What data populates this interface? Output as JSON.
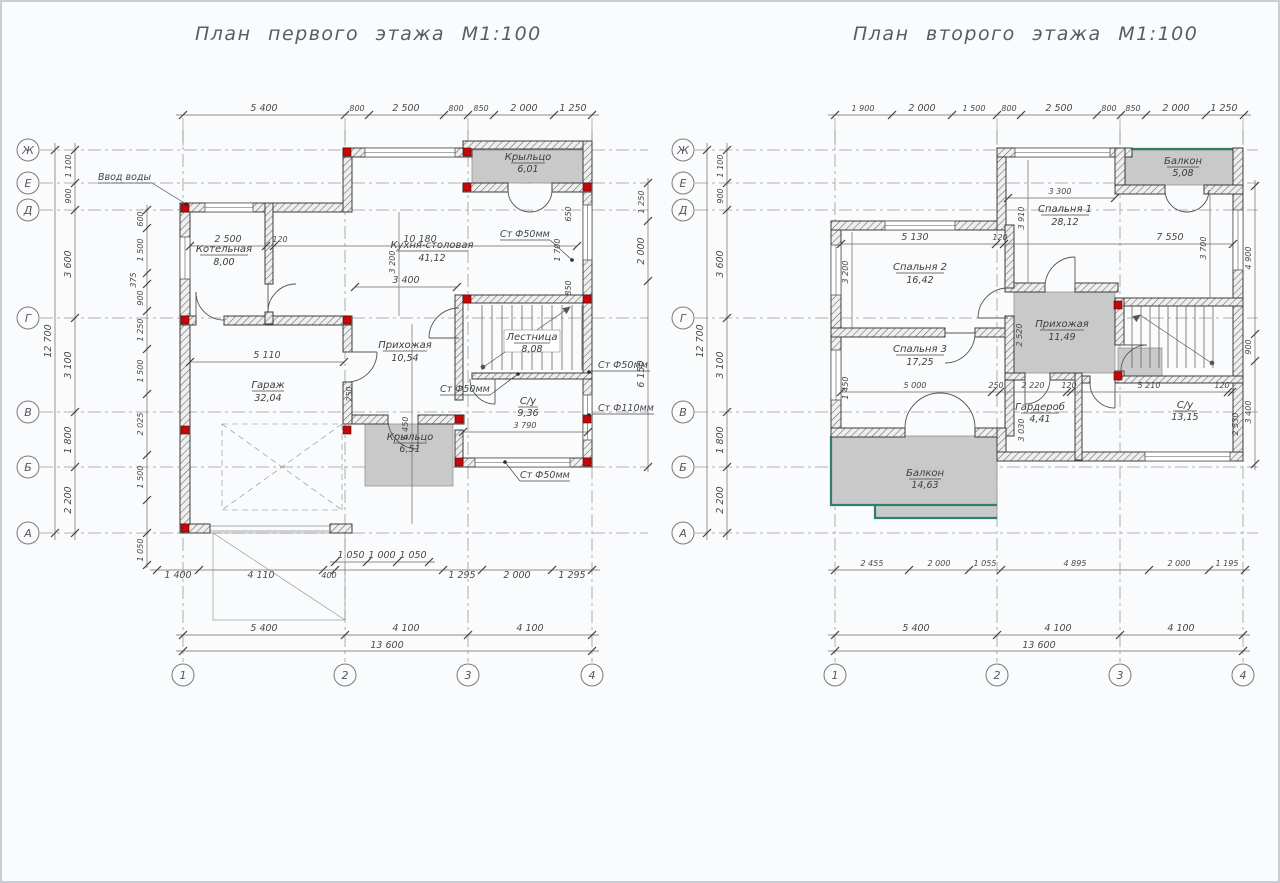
{
  "plans": {
    "first": {
      "title": "План первого этажа М1:100",
      "row_axes": [
        "Ж",
        "Е",
        "Д",
        "Г",
        "В",
        "Б",
        "А"
      ],
      "col_axes": [
        "1",
        "2",
        "3",
        "4"
      ],
      "dims_top": [
        "5 400",
        "800",
        "2 500",
        "800",
        "850",
        "2 000",
        "1 250"
      ],
      "dims_left": [
        "1 100",
        "900",
        "3 600",
        "3 100",
        "1 800",
        "2 200"
      ],
      "dim_left_total": "12 700",
      "dims_left_inner": [
        "600",
        "1 500",
        "375",
        "900",
        "1 250",
        "1 500",
        "2 025",
        "1 500",
        "1 050"
      ],
      "dims_right": [
        "1 250",
        "2 000",
        "6 150"
      ],
      "dims_bottom_a": [
        "1 400",
        "4 110",
        "400"
      ],
      "dims_bottom_b": [
        "1 050",
        "1 000",
        "1 050"
      ],
      "dims_bottom_c": [
        "1 295",
        "2 000",
        "1 295"
      ],
      "dims_bottom_axes": [
        "5 400",
        "4 100",
        "4 100"
      ],
      "dim_bottom_total": "13 600",
      "rooms": [
        {
          "name": "Котельная",
          "area": "8,00"
        },
        {
          "name": "Кухня-столовая",
          "area": "41,12"
        },
        {
          "name": "Прихожая",
          "area": "10,54"
        },
        {
          "name": "Гараж",
          "area": "32,04"
        },
        {
          "name": "Лестница",
          "area": "8,08"
        },
        {
          "name": "С/у",
          "area": "9,36"
        },
        {
          "name": "Крыльцо",
          "area": "6,51"
        },
        {
          "name": "Крыльцо",
          "area": "6,01"
        }
      ],
      "inner_dims": [
        "2 500",
        "120",
        "10 180",
        "3 400",
        "3 200",
        "5 110",
        "6 450",
        "250",
        "3 790",
        "650",
        "850",
        "1 700"
      ],
      "annotations": [
        "Ввод воды",
        "Ст Ф50мм",
        "Ст Ф50мм",
        "Ст Ф50мм",
        "Ст Ф110мм",
        "Ст Ф50мм"
      ]
    },
    "second": {
      "title": "План второго этажа М1:100",
      "row_axes": [
        "Ж",
        "Е",
        "Д",
        "Г",
        "В",
        "Б",
        "А"
      ],
      "col_axes": [
        "1",
        "2",
        "3",
        "4"
      ],
      "dims_top": [
        "1 900",
        "2 000",
        "1 500",
        "800",
        "2 500",
        "800",
        "850",
        "2 000",
        "1 250"
      ],
      "dims_left": [
        "1 100",
        "900",
        "3 600",
        "3 100",
        "1 800",
        "2 200"
      ],
      "dim_left_total": "12 700",
      "dims_right": [
        "4 900",
        "900",
        "3 400"
      ],
      "dims_bottom_a": [
        "2 455",
        "2 000",
        "1 055",
        "4 895",
        "2 000",
        "1 195"
      ],
      "dims_bottom_axes": [
        "5 400",
        "4 100",
        "4 100"
      ],
      "dim_bottom_total": "13 600",
      "rooms": [
        {
          "name": "Балкон",
          "area": "5,08"
        },
        {
          "name": "Спальня 1",
          "area": "28,12"
        },
        {
          "name": "Спальня 2",
          "area": "16,42"
        },
        {
          "name": "Спальня 3",
          "area": "17,25"
        },
        {
          "name": "Прихожая",
          "area": "11,49"
        },
        {
          "name": "Гардероб",
          "area": "4,41"
        },
        {
          "name": "С/у",
          "area": "13,15"
        },
        {
          "name": "Балкон",
          "area": "14,63"
        }
      ],
      "inner_dims": [
        "3 300",
        "5 130",
        "120",
        "7 550",
        "3 910",
        "3 200",
        "3 700",
        "2 520",
        "5 000",
        "250",
        "2 220",
        "120",
        "5 210",
        "120",
        "1 450",
        "3 030",
        "2 530"
      ]
    }
  }
}
